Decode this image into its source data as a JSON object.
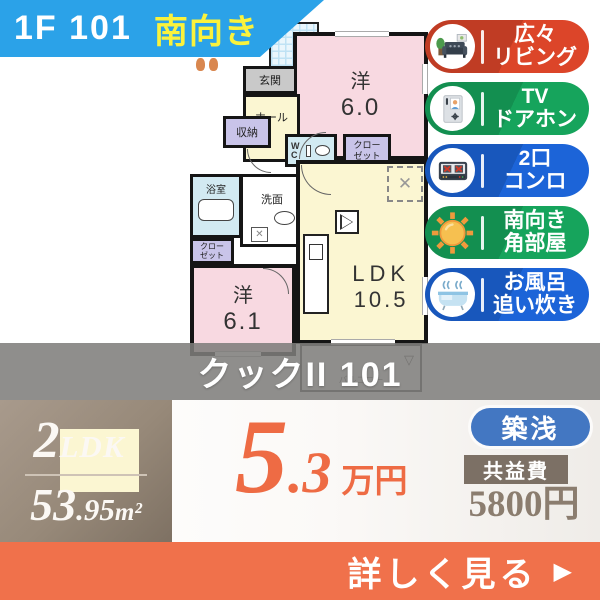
{
  "banner": {
    "unit_label": "1F 101",
    "facing_label": "南向き"
  },
  "floorplan": {
    "room_west_a": "洋",
    "room_west_a_size": "6.0",
    "room_west_b": "洋",
    "room_west_b_size": "6.1",
    "ldk_label": "LDK",
    "ldk_size": "10.5",
    "entrance": "玄関",
    "hall": "ホール",
    "storage": "収納",
    "wc": "WC",
    "closet_line1": "クロー",
    "closet_line2": "ゼット",
    "bathroom": "浴室",
    "washroom": "洗面",
    "balcony": "バルコニー",
    "fridge_mark": "✕",
    "washer_mark": "✕",
    "balcony_mark": "▽"
  },
  "badges": [
    {
      "line1": "広々",
      "line2": "リビング",
      "color": "#DC4529",
      "icon": "living-room-sofa-icon"
    },
    {
      "line1": "TV",
      "line2": "ドアホン",
      "color": "#16A45C",
      "icon": "tv-intercom-icon"
    },
    {
      "line1": "2口",
      "line2": "コンロ",
      "color": "#1C64D8",
      "icon": "two-burner-stove-icon"
    },
    {
      "line1": "南向き",
      "line2": "角部屋",
      "color": "#16A45C",
      "icon": "sun-icon"
    },
    {
      "line1": "お風呂",
      "line2": "追い炊き",
      "color": "#1C64D8",
      "icon": "bathtub-icon"
    }
  ],
  "overlay": {
    "building_name": "クックII 101"
  },
  "spec": {
    "layout_number": "2",
    "layout_type": "LDK",
    "area_main": "53",
    "area_decimal": ".95",
    "area_unit": "m²"
  },
  "pricing": {
    "rent_main": "5",
    "rent_decimal": ".3",
    "rent_unit": "万円",
    "age_badge": "築浅",
    "fee_label": "共益費",
    "fee_value": "5800円"
  },
  "cta": {
    "label": "詳しく見る",
    "arrow": "▶"
  },
  "colors": {
    "banner_blue": "#2BA2E8",
    "facing_yellow": "#FAF23C",
    "badge_red": "#DC4529",
    "badge_green": "#16A45C",
    "badge_blue": "#1C64D8",
    "overlay_gray": "#7E7D7B",
    "spec_taupe": "#978979",
    "price_orange": "#EE6B44",
    "cta_orange": "#F0714B",
    "age_pill_blue": "#4377C2",
    "fee_box_brown": "#7C7065",
    "plan_pink": "#F8D9E1",
    "plan_cream": "#FBF6D2",
    "plan_lavender": "#C9C4E9",
    "plan_lightblue": "#D2EAF2"
  }
}
